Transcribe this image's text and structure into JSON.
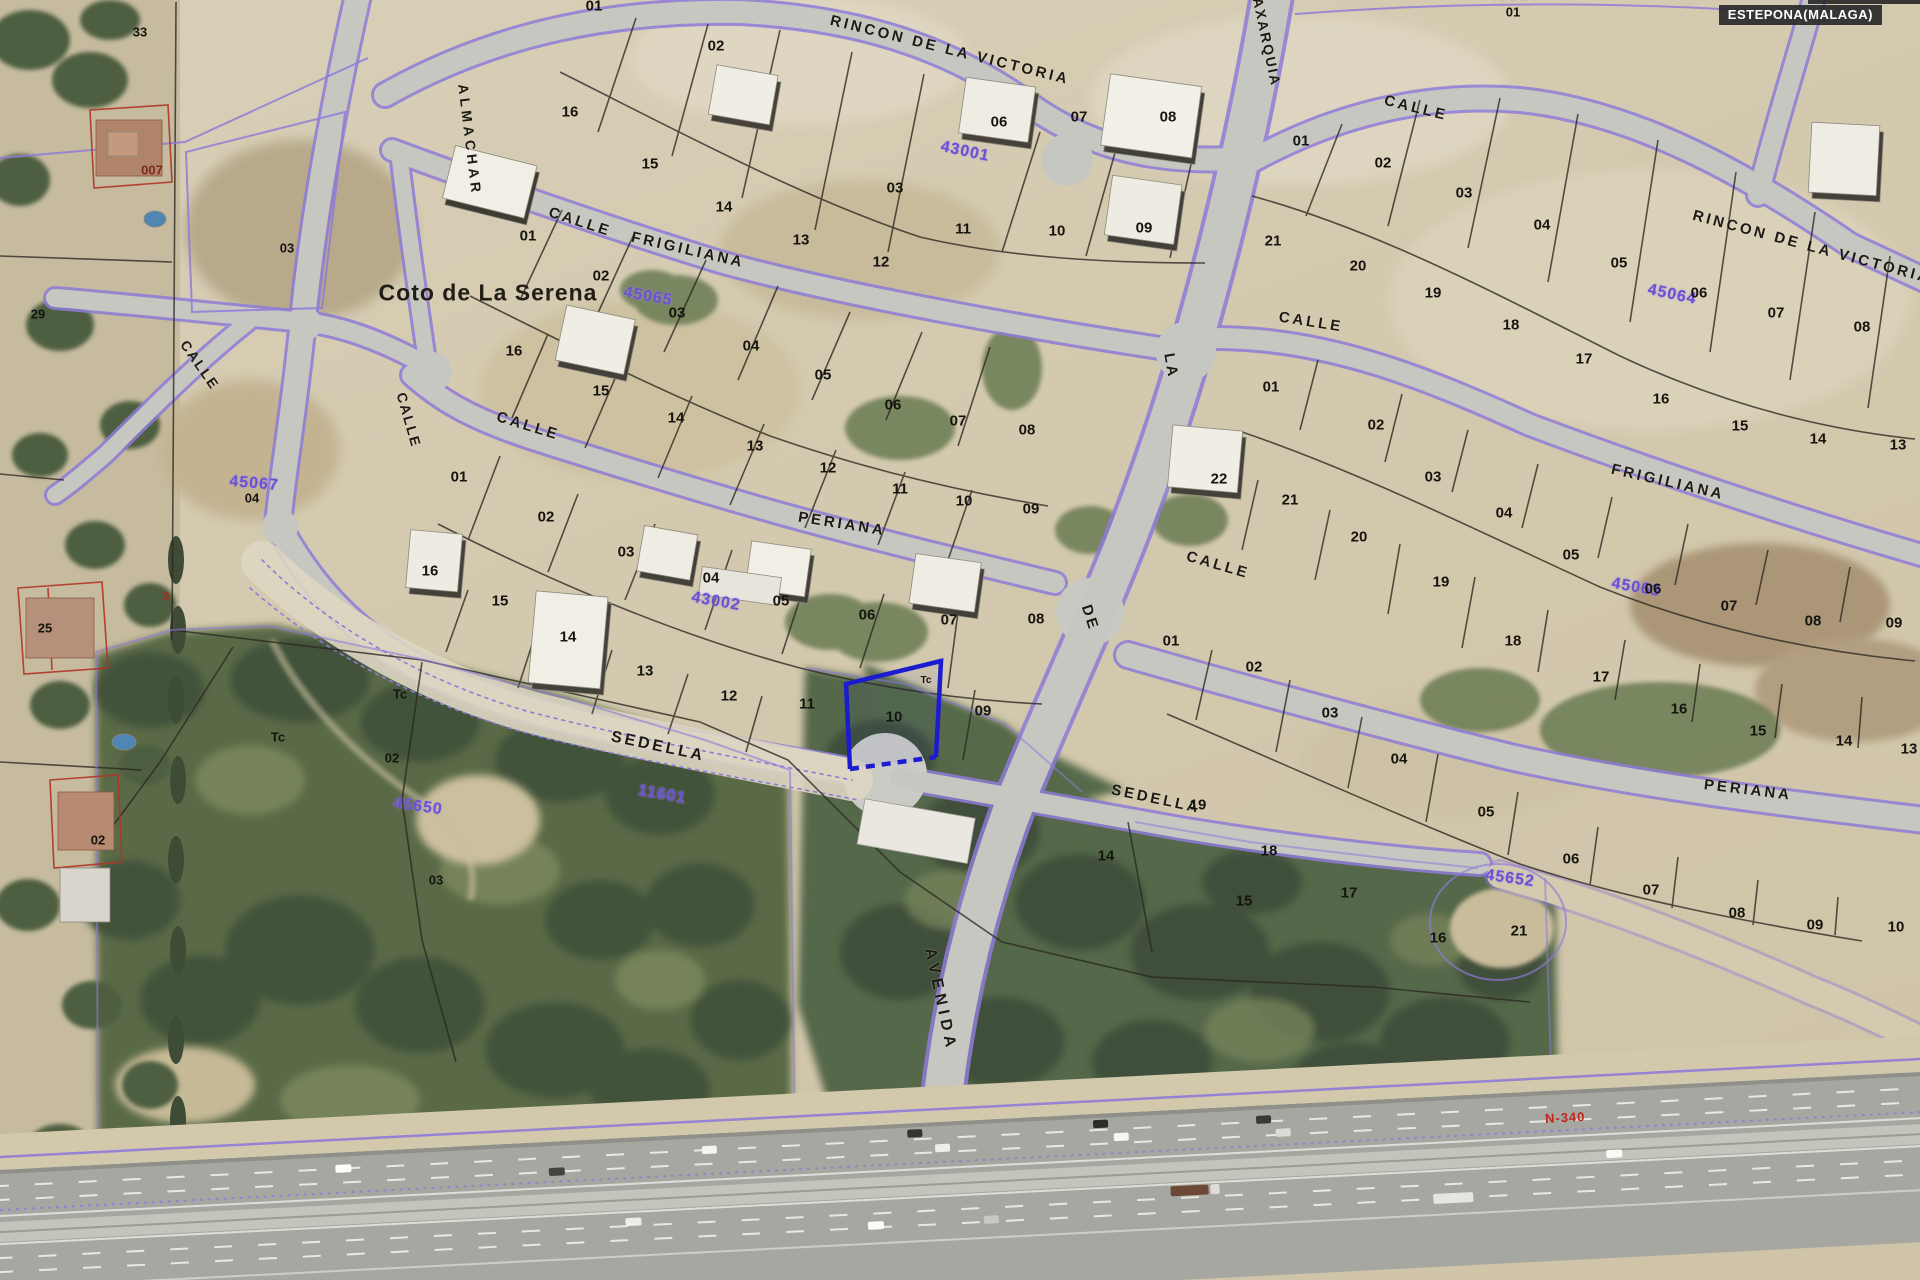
{
  "header": {
    "municipality_label": "ESTEPONA(MALAGA)"
  },
  "map": {
    "place_name": "Coto de La Serena",
    "highway_ref": "N-340",
    "street_labels": [
      {
        "t": "RINCON DE LA VICTORIA",
        "x": 950,
        "y": 50,
        "r": 14
      },
      {
        "t": "ALMACHAR",
        "x": 470,
        "y": 140,
        "r": 83,
        "ls": 4,
        "fs": 14
      },
      {
        "t": "CALLE",
        "x": 580,
        "y": 222,
        "r": 18
      },
      {
        "t": "FRIGILIANA",
        "x": 688,
        "y": 250,
        "r": 13
      },
      {
        "t": "CALLE",
        "x": 528,
        "y": 426,
        "r": 17
      },
      {
        "t": "PERIANA",
        "x": 842,
        "y": 524,
        "r": 9
      },
      {
        "t": "CALLE",
        "x": 409,
        "y": 420,
        "r": 74,
        "fs": 14,
        "ls": 2
      },
      {
        "t": "CALLE",
        "x": 200,
        "y": 365,
        "r": 55,
        "fs": 14,
        "ls": 2
      },
      {
        "t": "SEDELLA",
        "x": 658,
        "y": 747,
        "r": 12,
        "fs": 16
      },
      {
        "t": "AVENIDA",
        "x": 940,
        "y": 1000,
        "r": 78,
        "fs": 16,
        "ls": 5
      },
      {
        "t": "DE",
        "x": 1090,
        "y": 618,
        "r": 72
      },
      {
        "t": "LA",
        "x": 1171,
        "y": 366,
        "r": 80
      },
      {
        "t": "AXARQUIA",
        "x": 1267,
        "y": 42,
        "r": 78,
        "fs": 14,
        "ls": 2
      },
      {
        "t": "CALLE",
        "x": 1416,
        "y": 108,
        "r": 14
      },
      {
        "t": "RINCON DE LA VICTORIA",
        "x": 1812,
        "y": 247,
        "r": 15
      },
      {
        "t": "CALLE",
        "x": 1311,
        "y": 322,
        "r": 9
      },
      {
        "t": "FRIGILIANA",
        "x": 1668,
        "y": 482,
        "r": 13
      },
      {
        "t": "CALLE",
        "x": 1218,
        "y": 565,
        "r": 16
      },
      {
        "t": "PERIANA",
        "x": 1748,
        "y": 790,
        "r": 7
      },
      {
        "t": "SEDELLA",
        "x": 1156,
        "y": 799,
        "r": 12
      }
    ],
    "area_codes": [
      {
        "t": "45064",
        "x": 1672,
        "y": 295,
        "r": 12
      },
      {
        "t": "45063",
        "x": 1636,
        "y": 588,
        "r": 10
      },
      {
        "t": "45652",
        "x": 1510,
        "y": 879,
        "r": 8
      },
      {
        "t": "11601",
        "x": 662,
        "y": 795,
        "r": 10
      },
      {
        "t": "43002",
        "x": 716,
        "y": 602,
        "r": 10
      },
      {
        "t": "45065",
        "x": 648,
        "y": 297,
        "r": 10
      },
      {
        "t": "45067",
        "x": 254,
        "y": 484,
        "r": 5
      },
      {
        "t": "45650",
        "x": 418,
        "y": 807,
        "r": 8
      },
      {
        "t": "43001",
        "x": 965,
        "y": 152,
        "r": 12
      },
      {
        "t": "45064",
        "x": 1513,
        "y": -4,
        "r": 0
      }
    ],
    "parcel_numbers": [
      {
        "t": "01",
        "x": 594,
        "y": 6
      },
      {
        "t": "02",
        "x": 716,
        "y": 46
      },
      {
        "t": "03",
        "x": 895,
        "y": 188
      },
      {
        "t": "06",
        "x": 999,
        "y": 122
      },
      {
        "t": "07",
        "x": 1079,
        "y": 117
      },
      {
        "t": "08",
        "x": 1168,
        "y": 117
      },
      {
        "t": "16",
        "x": 570,
        "y": 112
      },
      {
        "t": "15",
        "x": 650,
        "y": 164
      },
      {
        "t": "14",
        "x": 724,
        "y": 207
      },
      {
        "t": "13",
        "x": 801,
        "y": 240
      },
      {
        "t": "12",
        "x": 881,
        "y": 262
      },
      {
        "t": "11",
        "x": 963,
        "y": 229
      },
      {
        "t": "10",
        "x": 1057,
        "y": 231
      },
      {
        "t": "09",
        "x": 1144,
        "y": 228
      },
      {
        "t": "01",
        "x": 528,
        "y": 236
      },
      {
        "t": "02",
        "x": 601,
        "y": 276
      },
      {
        "t": "03",
        "x": 677,
        "y": 313
      },
      {
        "t": "04",
        "x": 751,
        "y": 346
      },
      {
        "t": "05",
        "x": 823,
        "y": 375
      },
      {
        "t": "06",
        "x": 893,
        "y": 405
      },
      {
        "t": "07",
        "x": 958,
        "y": 421
      },
      {
        "t": "08",
        "x": 1027,
        "y": 430
      },
      {
        "t": "16",
        "x": 514,
        "y": 351
      },
      {
        "t": "15",
        "x": 601,
        "y": 391
      },
      {
        "t": "14",
        "x": 676,
        "y": 418
      },
      {
        "t": "13",
        "x": 755,
        "y": 446
      },
      {
        "t": "12",
        "x": 828,
        "y": 468
      },
      {
        "t": "11",
        "x": 900,
        "y": 489
      },
      {
        "t": "10",
        "x": 964,
        "y": 501
      },
      {
        "t": "09",
        "x": 1031,
        "y": 509
      },
      {
        "t": "01",
        "x": 459,
        "y": 477
      },
      {
        "t": "02",
        "x": 546,
        "y": 517
      },
      {
        "t": "03",
        "x": 626,
        "y": 552
      },
      {
        "t": "04",
        "x": 711,
        "y": 578
      },
      {
        "t": "05",
        "x": 781,
        "y": 601
      },
      {
        "t": "06",
        "x": 867,
        "y": 615
      },
      {
        "t": "07",
        "x": 949,
        "y": 620
      },
      {
        "t": "08",
        "x": 1036,
        "y": 619
      },
      {
        "t": "16",
        "x": 430,
        "y": 571
      },
      {
        "t": "15",
        "x": 500,
        "y": 601
      },
      {
        "t": "14",
        "x": 568,
        "y": 637
      },
      {
        "t": "13",
        "x": 645,
        "y": 671
      },
      {
        "t": "12",
        "x": 729,
        "y": 696
      },
      {
        "t": "11",
        "x": 807,
        "y": 704
      },
      {
        "t": "10",
        "x": 894,
        "y": 717
      },
      {
        "t": "09",
        "x": 983,
        "y": 711
      },
      {
        "t": "01",
        "x": 1301,
        "y": 141
      },
      {
        "t": "02",
        "x": 1383,
        "y": 163
      },
      {
        "t": "03",
        "x": 1464,
        "y": 193
      },
      {
        "t": "04",
        "x": 1542,
        "y": 225
      },
      {
        "t": "05",
        "x": 1619,
        "y": 263
      },
      {
        "t": "06",
        "x": 1699,
        "y": 293
      },
      {
        "t": "07",
        "x": 1776,
        "y": 313
      },
      {
        "t": "08",
        "x": 1862,
        "y": 327
      },
      {
        "t": "21",
        "x": 1273,
        "y": 241
      },
      {
        "t": "20",
        "x": 1358,
        "y": 266
      },
      {
        "t": "19",
        "x": 1433,
        "y": 293
      },
      {
        "t": "18",
        "x": 1511,
        "y": 325
      },
      {
        "t": "17",
        "x": 1584,
        "y": 359
      },
      {
        "t": "16",
        "x": 1661,
        "y": 399
      },
      {
        "t": "15",
        "x": 1740,
        "y": 426
      },
      {
        "t": "14",
        "x": 1818,
        "y": 439
      },
      {
        "t": "13",
        "x": 1898,
        "y": 445
      },
      {
        "t": "01",
        "x": 1271,
        "y": 387
      },
      {
        "t": "02",
        "x": 1376,
        "y": 425
      },
      {
        "t": "03",
        "x": 1433,
        "y": 477
      },
      {
        "t": "04",
        "x": 1504,
        "y": 513
      },
      {
        "t": "05",
        "x": 1571,
        "y": 555
      },
      {
        "t": "06",
        "x": 1653,
        "y": 589
      },
      {
        "t": "07",
        "x": 1729,
        "y": 606
      },
      {
        "t": "08",
        "x": 1813,
        "y": 621
      },
      {
        "t": "09",
        "x": 1894,
        "y": 623
      },
      {
        "t": "22",
        "x": 1219,
        "y": 479
      },
      {
        "t": "21",
        "x": 1290,
        "y": 500
      },
      {
        "t": "20",
        "x": 1359,
        "y": 537
      },
      {
        "t": "19",
        "x": 1441,
        "y": 582
      },
      {
        "t": "18",
        "x": 1513,
        "y": 641
      },
      {
        "t": "17",
        "x": 1601,
        "y": 677
      },
      {
        "t": "16",
        "x": 1679,
        "y": 709
      },
      {
        "t": "15",
        "x": 1758,
        "y": 731
      },
      {
        "t": "14",
        "x": 1844,
        "y": 741
      },
      {
        "t": "13",
        "x": 1909,
        "y": 749
      },
      {
        "t": "01",
        "x": 1171,
        "y": 641
      },
      {
        "t": "02",
        "x": 1254,
        "y": 667
      },
      {
        "t": "03",
        "x": 1330,
        "y": 713
      },
      {
        "t": "04",
        "x": 1399,
        "y": 759
      },
      {
        "t": "05",
        "x": 1486,
        "y": 812
      },
      {
        "t": "06",
        "x": 1571,
        "y": 859
      },
      {
        "t": "07",
        "x": 1651,
        "y": 890
      },
      {
        "t": "08",
        "x": 1737,
        "y": 913
      },
      {
        "t": "09",
        "x": 1815,
        "y": 925
      },
      {
        "t": "10",
        "x": 1896,
        "y": 927
      },
      {
        "t": "19",
        "x": 1198,
        "y": 805
      },
      {
        "t": "18",
        "x": 1269,
        "y": 851
      },
      {
        "t": "17",
        "x": 1349,
        "y": 893
      },
      {
        "t": "16",
        "x": 1438,
        "y": 938
      },
      {
        "t": "14",
        "x": 1106,
        "y": 856
      },
      {
        "t": "15",
        "x": 1244,
        "y": 901
      },
      {
        "t": "21",
        "x": 1519,
        "y": 931
      }
    ],
    "misc_labels": [
      {
        "t": "Tc",
        "x": 400,
        "y": 694
      },
      {
        "t": "Tc",
        "x": 278,
        "y": 737
      },
      {
        "t": "Tc",
        "x": 926,
        "y": 681,
        "fs": 10
      },
      {
        "t": "33",
        "x": 140,
        "y": 32
      },
      {
        "t": "007",
        "x": 152,
        "y": 170,
        "cls": "misc darkred"
      },
      {
        "t": "03",
        "x": 287,
        "y": 248
      },
      {
        "t": "29",
        "x": 38,
        "y": 314
      },
      {
        "t": "25",
        "x": 45,
        "y": 628
      },
      {
        "t": "04",
        "x": 252,
        "y": 498
      },
      {
        "t": "02",
        "x": 98,
        "y": 840
      },
      {
        "t": "3",
        "x": 166,
        "y": 596,
        "cls": "misc red",
        "fs": 12
      },
      {
        "t": "02",
        "x": 392,
        "y": 758
      },
      {
        "t": "03",
        "x": 436,
        "y": 880
      },
      {
        "t": "01",
        "x": 1513,
        "y": 12
      }
    ]
  }
}
